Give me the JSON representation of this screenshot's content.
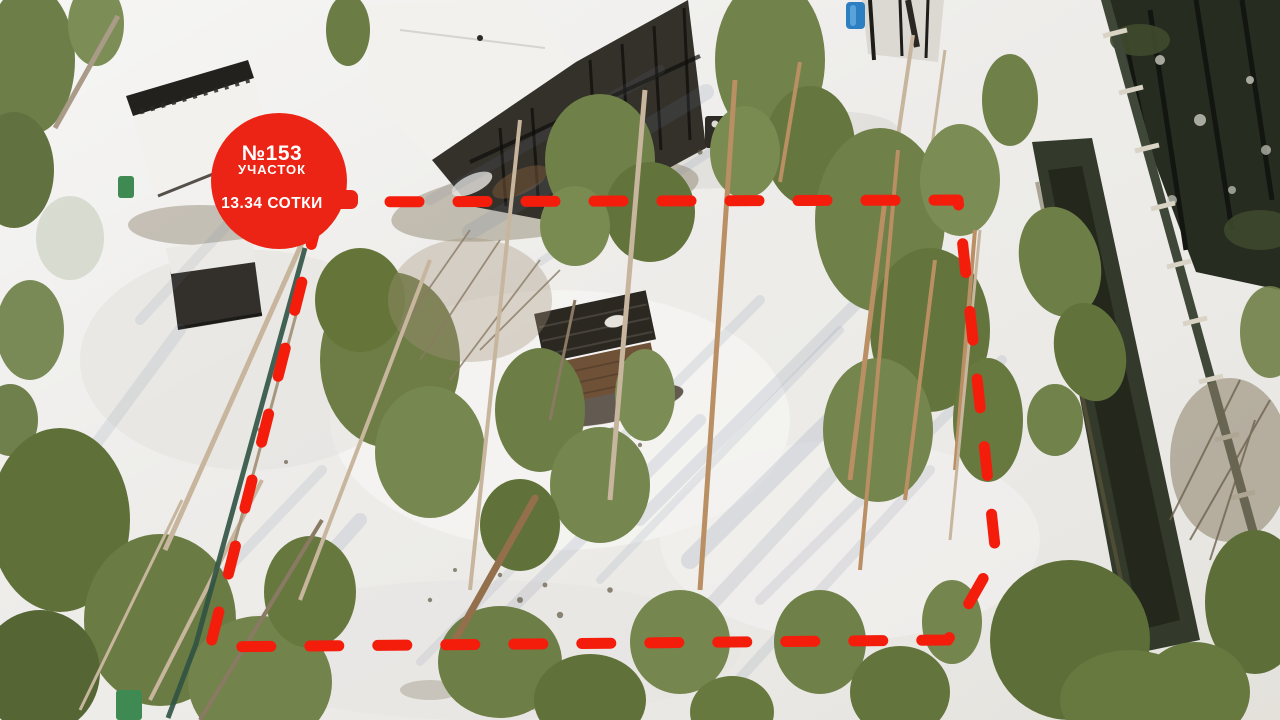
{
  "badge": {
    "plot_number": "№153",
    "plot_type_label": "УЧАСТОК",
    "area_label": "13.34 СОТКИ",
    "bg_color": "#ec2415",
    "text_color": "#ffffff"
  },
  "boundary": {
    "stroke_color": "#f41d0c",
    "points": "322,202 958,200 996,556 948,640 210,647",
    "dash_pattern": "29 39",
    "stroke_width": 11
  },
  "scene": {
    "snow_color": "#ebeae7",
    "forest_green": "#74854d",
    "dark_forest_color": "#272c20",
    "ditch_color": "#343a2b",
    "fence_color": "#3f4739",
    "shadow_color": "#6c7c9b",
    "building_dark": "#34312b",
    "roof_white": "#f2f1ee",
    "deck_brown": "#6e5137",
    "trunk_light": "#c7b69d",
    "trunk_pine": "#b98f63"
  }
}
